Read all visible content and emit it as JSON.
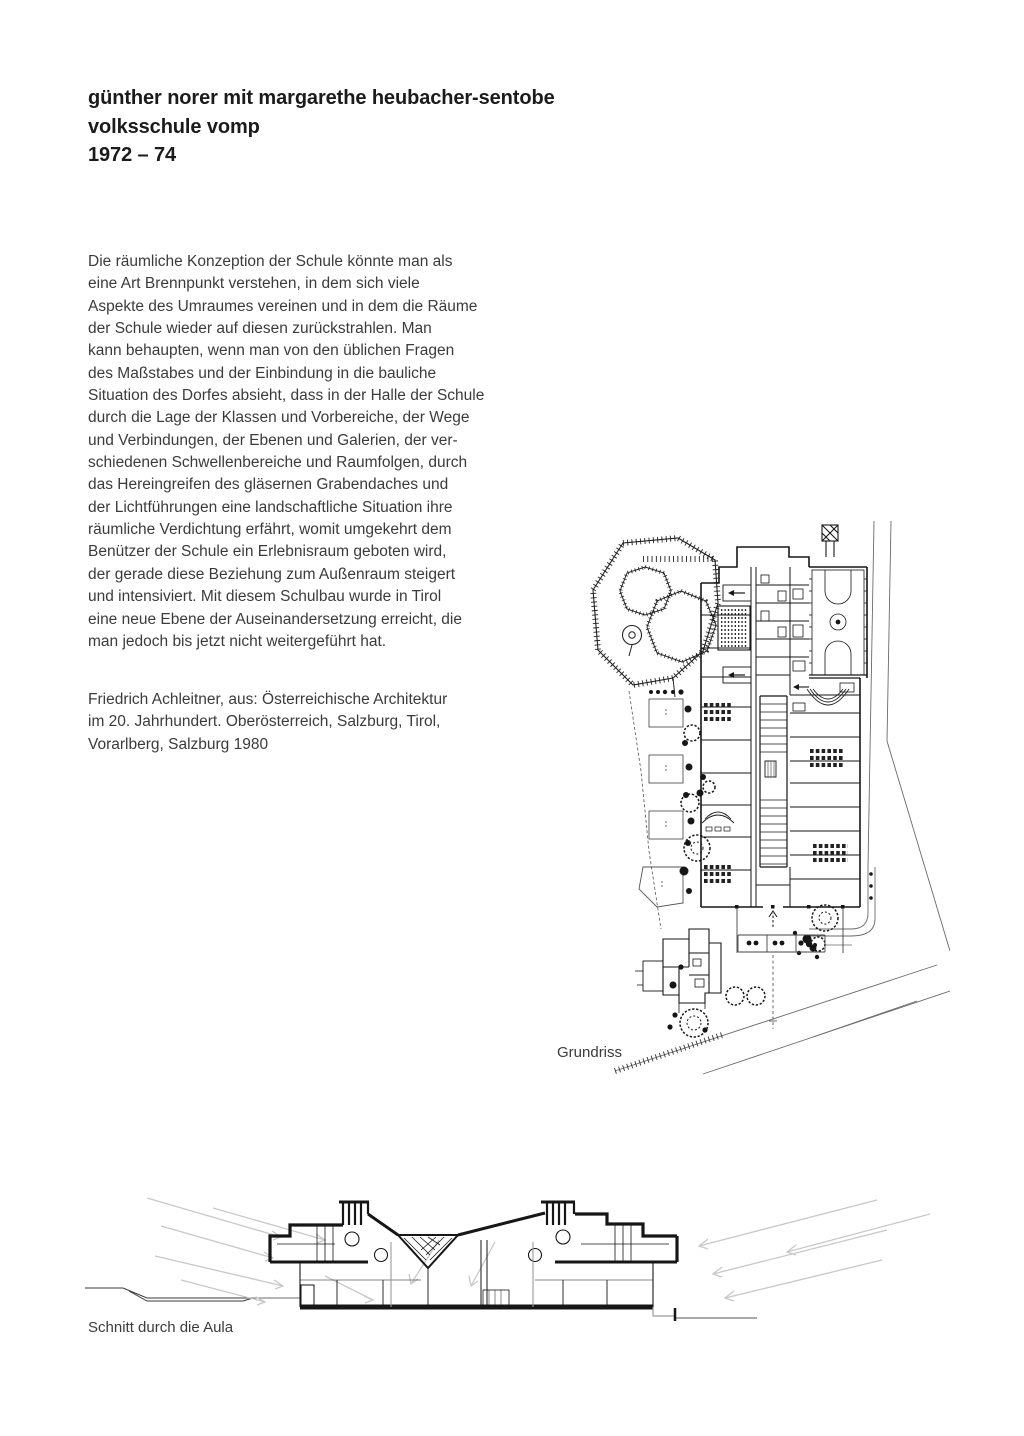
{
  "page": {
    "background": "#ffffff",
    "ink_color": "#1b1b1b",
    "text_color": "#3b3b3b"
  },
  "header": {
    "line1": "günther norer mit margarethe heubacher-sentobe",
    "line2": "volksschule vomp",
    "line3": "1972 – 74"
  },
  "article": {
    "paragraph_lines": [
      "Die räumliche Konzeption der Schule könnte man als",
      "eine Art Brennpunkt verstehen, in dem sich viele",
      "Aspekte des Umraumes vereinen und in dem die Räume",
      "der Schule wieder auf diesen zurückstrahlen. Man",
      "kann behaupten, wenn man von den üblichen Fragen",
      "des Maßstabes und der Einbindung in die bauliche",
      "Situation des Dorfes absieht, dass in der Halle der Schule",
      "durch die Lage der Klassen und Vorbereiche, der Wege",
      "und Verbindungen, der Ebenen und Galerien, der ver-",
      "schiedenen Schwellenbereiche und Raumfolgen, durch",
      "das Hereingreifen des gläsernen Grabendaches und",
      "der Lichtführungen eine landschaftliche Situation ihre",
      "räumliche Verdichtung erfährt, womit umgekehrt dem",
      "Benützer der Schule ein Erlebnisraum geboten wird,",
      "der gerade diese Beziehung zum Außenraum steigert",
      "und intensiviert. Mit diesem Schulbau wurde in Tirol",
      "eine neue Ebene der Auseinandersetzung erreicht, die",
      "man jedoch bis jetzt nicht weitergeführt hat."
    ],
    "credit_lines": [
      "Friedrich Achleitner, aus: Österreichische Architektur",
      "im 20. Jahrhundert. Oberösterreich, Salzburg, Tirol,",
      "Vorarlberg, Salzburg 1980"
    ]
  },
  "figures": {
    "plan": {
      "caption": "Grundriss"
    },
    "section": {
      "caption": "Schnitt durch die Aula"
    }
  }
}
